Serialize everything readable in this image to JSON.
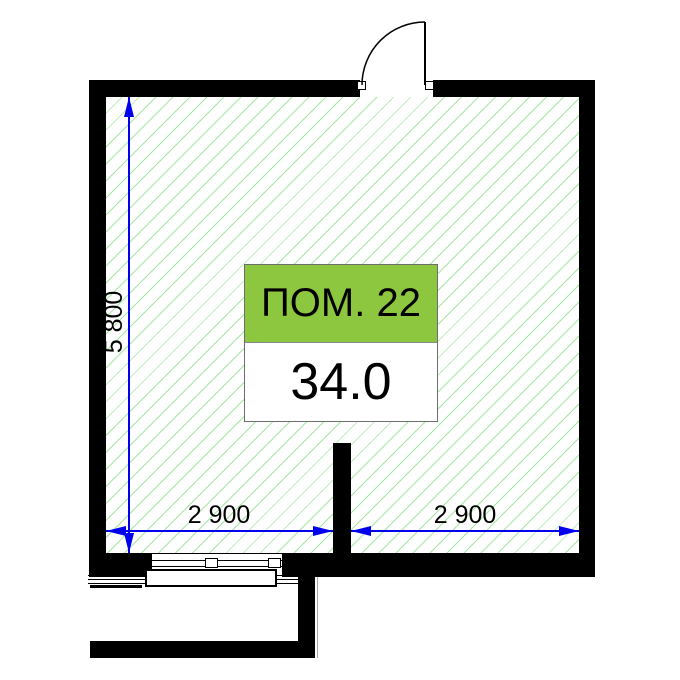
{
  "plan": {
    "room": {
      "name": "ПОМ. 22",
      "area": "34.0"
    },
    "dimensions": {
      "vertical": "5 800",
      "horizontal_left": "2 900",
      "horizontal_right": "2 900"
    },
    "colors": {
      "wall": "#000000",
      "dimension_line": "#0000ee",
      "room_label_bg": "#8dc63f",
      "hatch_line": "#a5e6a5",
      "hairline": "#aaaaaa",
      "background": "#ffffff"
    }
  }
}
